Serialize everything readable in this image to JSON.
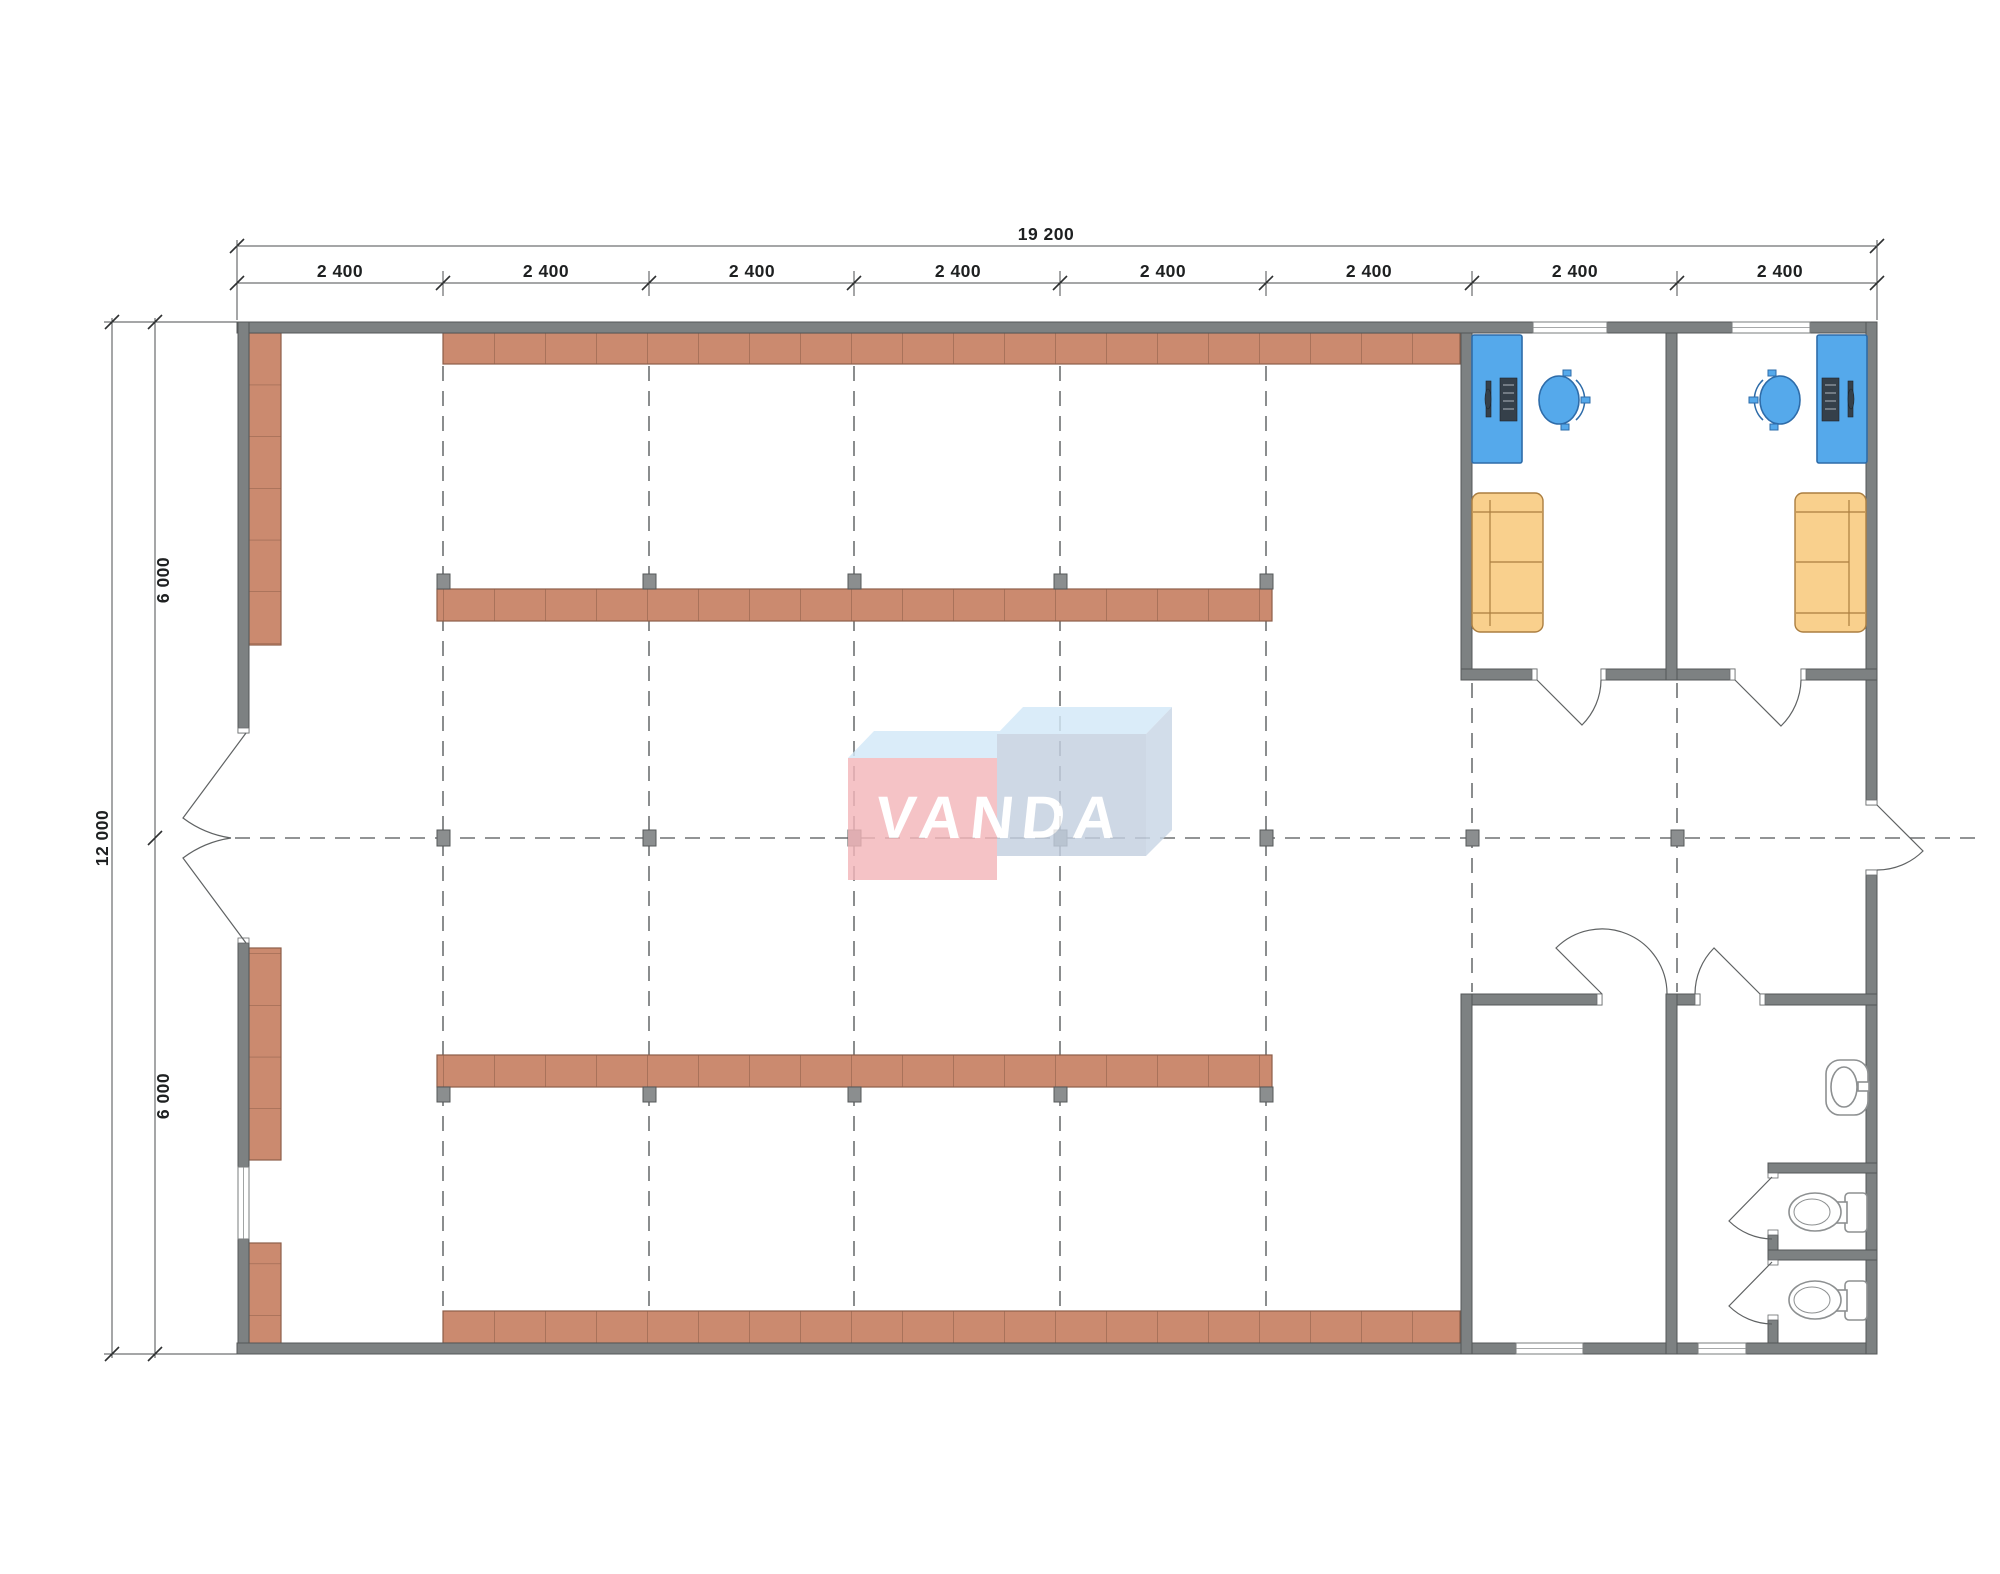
{
  "drawing": {
    "type": "architectural floor plan",
    "watermark_logo_text": "VANDA"
  },
  "dimensions_top": {
    "total_width_label": "19 200",
    "bay_labels": [
      "2 400",
      "2 400",
      "2 400",
      "2 400",
      "2 400",
      "2 400",
      "2 400",
      "2 400"
    ]
  },
  "dimensions_left": {
    "total_height_label": "12 000",
    "upper_half_label": "6 000",
    "lower_half_label": "6 000"
  },
  "icons": [
    "computer-icon",
    "office-chair-icon",
    "sofa-icon",
    "toilet-icon",
    "sink-icon",
    "door-swing-icon",
    "column-marker-icon"
  ],
  "colors": {
    "wall": "#7d8182",
    "shelf": "#cb8a6f",
    "shelf_line": "#8d5e49",
    "desk_blue": "#55a9eb",
    "sofa_orange": "#f9d08d",
    "marker_gray": "#8b8e8f",
    "grid_dash": "#6e7172",
    "logo_pink": "#f3b6ba",
    "logo_blue_face": "#c4d0e0",
    "logo_top": "#d3e9f8",
    "logo_side": "#c9d6e6"
  }
}
